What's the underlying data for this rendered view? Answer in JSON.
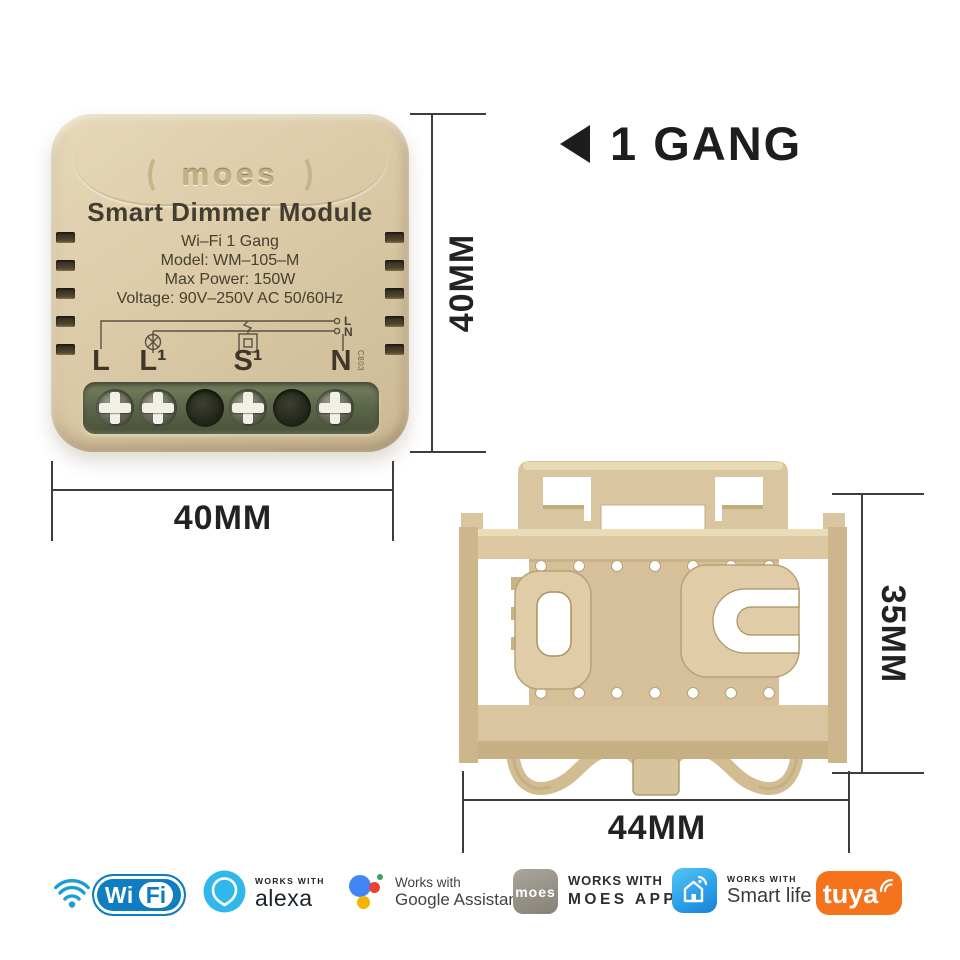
{
  "heading": {
    "label": "1 GANG"
  },
  "device": {
    "brand": "moes",
    "title": "Smart Dimmer Module",
    "specs": [
      "Wi–Fi 1 Gang",
      "Model: WM–105–M",
      "Max Power: 150W",
      "Voltage: 90V–250V AC 50/60Hz"
    ],
    "terminal_labels": [
      "L",
      "L¹",
      "S¹",
      "N"
    ],
    "output_labels": [
      "L",
      "N"
    ],
    "side_code": "C803"
  },
  "dimensions": {
    "front_height": "40MM",
    "front_width": "40MM",
    "bracket_height": "35MM",
    "bracket_width": "44MM"
  },
  "badges": {
    "wifi": {
      "wi": "Wi",
      "fi": "Fi"
    },
    "alexa": {
      "caption": "WORKS WITH",
      "name": "alexa"
    },
    "google": {
      "caption": "Works with",
      "name": "Google Assistant"
    },
    "moes_app": {
      "icon_label": "moes",
      "caption": "WORKS WITH",
      "name": "MOES APP"
    },
    "smart_life": {
      "caption": "WORKS WITH",
      "name": "Smart life"
    },
    "tuya": {
      "name": "tuya"
    }
  },
  "colors": {
    "device_body": "#dccaa8",
    "terminal_block": "#5d684a",
    "bracket": "#d9c6a0",
    "dimension_line": "#3d3d3d",
    "heading_text": "#1d1d1d",
    "wifi_blue": "#0f7dc2",
    "alexa_blue": "#31b8eb",
    "google_blue": "#4285f4",
    "google_red": "#ea4335",
    "google_yellow": "#f4b400",
    "google_green": "#34a853",
    "moes_gray": "#948f84",
    "smartlife_blue": "#2496e4",
    "tuya_orange": "#f4731c"
  }
}
